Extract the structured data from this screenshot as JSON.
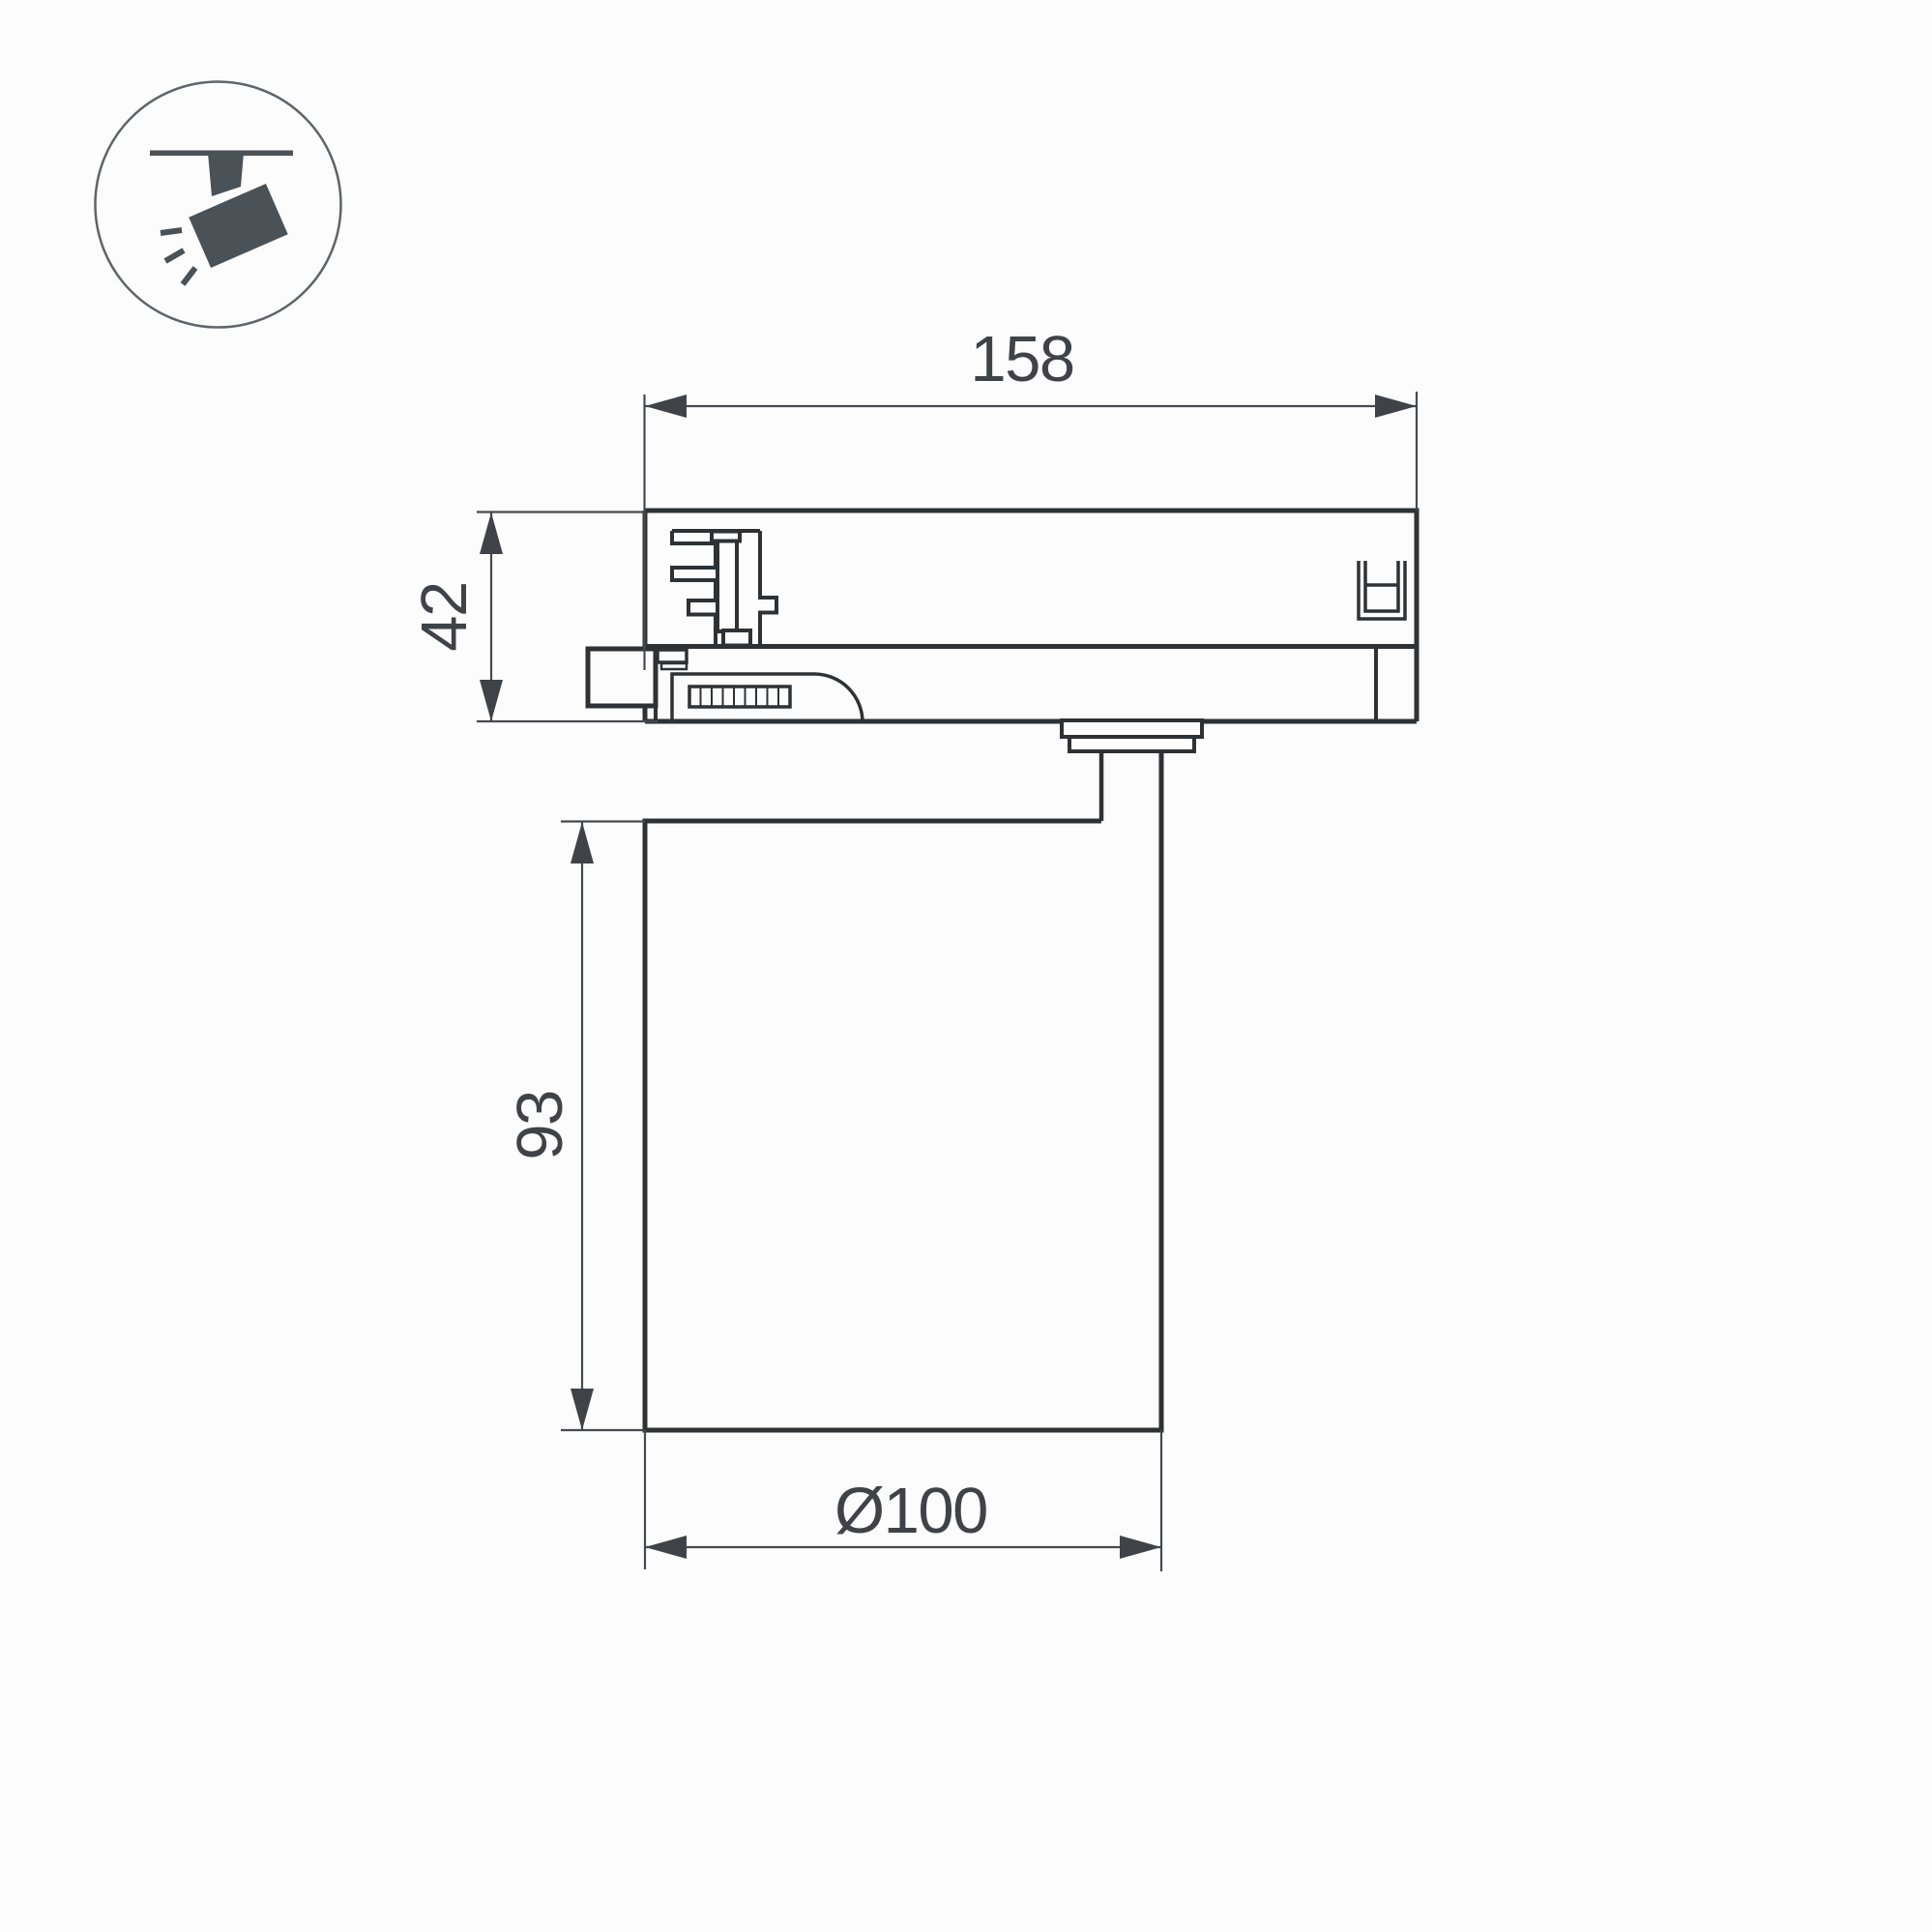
{
  "page": {
    "background": "#fcfcfc",
    "kind": "technical dimension drawing of a track-mounted spotlight"
  },
  "icon": {
    "name": "track-spotlight-icon",
    "glyph_color": "#4a5157",
    "ring_color": "#606468"
  },
  "drawing": {
    "outline_color": "#2e3235",
    "dimension_color": "#46494d",
    "dimensions": {
      "adapter_width": "158",
      "adapter_height": "42",
      "body_height": "93",
      "body_diameter": "Ø100"
    }
  }
}
